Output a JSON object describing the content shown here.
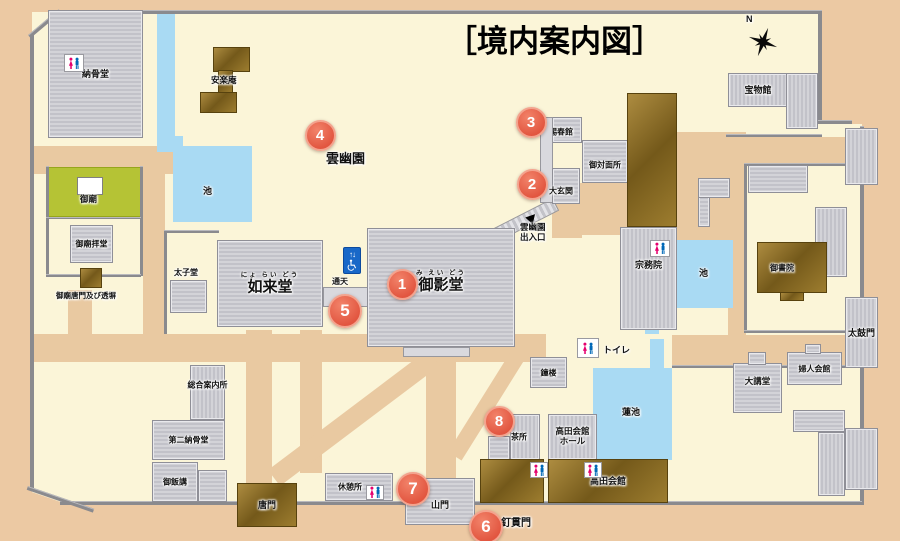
{
  "title": "［境内案内図］",
  "colors": {
    "accent": "#e25640",
    "water": "#a9daf3",
    "grounds": "#fbf5d8",
    "road": "#e9c9a1",
    "mausoleum_green": "#b5c335",
    "roof_gray": "#c9c9ce",
    "roof_brown": "#8a6c23",
    "wall": "#8a8a8e",
    "elevator_blue": "#1968c8",
    "toilet_pink": "#e5006e",
    "toilet_blue": "#0068b7"
  },
  "areas": [
    {
      "name": "grounds-base",
      "cls": "cream",
      "rect": [
        32,
        12,
        830,
        492
      ]
    },
    {
      "name": "outside-sw-corner",
      "cls": "tan",
      "rect": [
        20,
        488,
        88,
        42
      ],
      "rot": 19
    },
    {
      "name": "outside-ne-corner",
      "cls": "tan",
      "rect": [
        820,
        12,
        42,
        112
      ]
    },
    {
      "name": "road-north-of-gobyo",
      "cls": "road",
      "rect": [
        34,
        146,
        140,
        28
      ]
    },
    {
      "name": "road-west-vertical",
      "cls": "road",
      "rect": [
        143,
        148,
        22,
        190
      ]
    },
    {
      "name": "road-karamon-vertical",
      "cls": "road",
      "rect": [
        246,
        330,
        26,
        173
      ]
    },
    {
      "name": "road-main-horizontal",
      "cls": "road",
      "rect": [
        34,
        334,
        512,
        28
      ]
    },
    {
      "name": "road-sanmon-vertical",
      "cls": "road",
      "rect": [
        426,
        356,
        30,
        147
      ]
    },
    {
      "name": "road-center-vertical",
      "cls": "road",
      "rect": [
        300,
        330,
        22,
        143
      ]
    },
    {
      "name": "road-gobyo-gate",
      "cls": "road",
      "rect": [
        68,
        290,
        24,
        48
      ]
    },
    {
      "name": "road-homotsukan",
      "cls": "road",
      "rect": [
        726,
        137,
        120,
        26
      ]
    },
    {
      "name": "road-ne-vertical",
      "cls": "road",
      "rect": [
        728,
        150,
        18,
        185
      ]
    },
    {
      "name": "road-ne-block",
      "cls": "road",
      "rect": [
        677,
        132,
        69,
        108
      ]
    },
    {
      "name": "road-to-taikomon",
      "cls": "road",
      "rect": [
        672,
        335,
        190,
        30
      ]
    },
    {
      "name": "road-genkan-south",
      "cls": "road",
      "rect": [
        552,
        204,
        30,
        34
      ]
    },
    {
      "name": "road-genkan-east",
      "cls": "road",
      "rect": [
        580,
        183,
        48,
        52
      ]
    },
    {
      "name": "road-diagonal-sw",
      "cls": "road",
      "rect": [
        268,
        470,
        200,
        20
      ],
      "rot": -37
    },
    {
      "name": "road-diagonal-ne",
      "cls": "road",
      "rect": [
        448,
        452,
        130,
        16
      ],
      "rot": -58
    },
    {
      "name": "canal",
      "cls": "water",
      "rect": [
        157,
        12,
        18,
        126
      ]
    },
    {
      "name": "canal-bend",
      "cls": "water",
      "rect": [
        157,
        136,
        26,
        16
      ]
    },
    {
      "name": "pond-west",
      "cls": "water",
      "rect": [
        173,
        146,
        79,
        76
      ]
    },
    {
      "name": "pond-east",
      "cls": "water",
      "rect": [
        674,
        240,
        59,
        68
      ]
    },
    {
      "name": "pond-outlet",
      "cls": "water",
      "rect": [
        645,
        318,
        14,
        16
      ]
    },
    {
      "name": "lotus-pond",
      "cls": "water",
      "rect": [
        593,
        368,
        79,
        92
      ]
    },
    {
      "name": "lotus-channel",
      "cls": "water",
      "rect": [
        650,
        339,
        14,
        31
      ]
    },
    {
      "name": "gobyo-mausoleum-green",
      "cls": "green",
      "rect": [
        47,
        167,
        94,
        50
      ]
    },
    {
      "name": "entrance-stairs",
      "cls": "stairs",
      "rect": [
        494,
        228,
        66,
        14
      ],
      "rot": -27
    }
  ],
  "walls": [
    {
      "name": "wall-top",
      "rect": [
        57,
        10,
        763,
        4
      ]
    },
    {
      "name": "wall-ne-vertical",
      "rect": [
        818,
        10,
        4,
        112
      ]
    },
    {
      "name": "wall-ne-horizontal",
      "rect": [
        818,
        120,
        34,
        4
      ]
    },
    {
      "name": "wall-east",
      "rect": [
        860,
        126,
        4,
        379
      ]
    },
    {
      "name": "wall-south",
      "rect": [
        60,
        501,
        802,
        4
      ]
    },
    {
      "name": "wall-west",
      "rect": [
        30,
        34,
        4,
        455
      ]
    },
    {
      "name": "wall-nw-diagonal",
      "rect": [
        28,
        35,
        40,
        4
      ],
      "rot": -40
    },
    {
      "name": "wall-sw-diagonal",
      "rect": [
        28,
        486,
        70,
        4
      ],
      "rot": 19
    },
    {
      "name": "wall-lotus-north",
      "rect": [
        672,
        365,
        190,
        3
      ]
    },
    {
      "name": "fence-homotsukan",
      "rect": [
        726,
        134,
        96,
        3
      ]
    },
    {
      "name": "wall-ne-compound-west",
      "rect": [
        744,
        163,
        3,
        170
      ]
    },
    {
      "name": "wall-ne-compound-north",
      "rect": [
        744,
        163,
        118,
        3
      ]
    },
    {
      "name": "wall-ne-compound-south",
      "rect": [
        744,
        330,
        118,
        3
      ]
    },
    {
      "name": "wall-gobyo-west",
      "rect": [
        46,
        166,
        3,
        110
      ]
    },
    {
      "name": "wall-gobyo-east",
      "rect": [
        140,
        166,
        3,
        110
      ]
    },
    {
      "name": "wall-gobyo-mid",
      "rect": [
        46,
        217,
        95,
        2
      ]
    },
    {
      "name": "wall-gobyo-south",
      "rect": [
        46,
        274,
        95,
        3
      ]
    },
    {
      "name": "wall-taishido-west",
      "rect": [
        164,
        230,
        3,
        104
      ]
    },
    {
      "name": "wall-taishido-north",
      "rect": [
        164,
        230,
        55,
        3
      ]
    }
  ],
  "buildings": [
    {
      "name": "nokotsudo",
      "label": "納骨堂",
      "fs": 9,
      "cls": "b-gray",
      "rect": [
        48,
        10,
        95,
        128
      ]
    },
    {
      "name": "anrakuan-north",
      "cls": "b-brown",
      "rect": [
        213,
        47,
        37,
        25
      ]
    },
    {
      "name": "anrakuan-connector",
      "cls": "b-brown",
      "rect": [
        218,
        70,
        15,
        23
      ]
    },
    {
      "name": "anrakuan-south",
      "cls": "b-brown",
      "rect": [
        200,
        92,
        37,
        21
      ]
    },
    {
      "name": "homotsukan",
      "label": "宝物館",
      "fs": 9,
      "cls": "b-grayv",
      "rect": [
        728,
        73,
        60,
        34
      ]
    },
    {
      "name": "homotsukan-wing",
      "cls": "b-grayv",
      "rect": [
        786,
        73,
        32,
        56
      ]
    },
    {
      "name": "gobyo-worship-hall",
      "label": "御廟拝堂",
      "fs": 8,
      "cls": "b-gray",
      "rect": [
        70,
        225,
        43,
        38
      ]
    },
    {
      "name": "gobyo-karamon-gate",
      "cls": "b-brown",
      "rect": [
        80,
        268,
        22,
        20
      ]
    },
    {
      "name": "taishido",
      "cls": "b-gray",
      "rect": [
        170,
        280,
        37,
        33
      ]
    },
    {
      "name": "nyoraido",
      "label": "如来堂",
      "fs": 15,
      "furigana": "にょ らい どう",
      "cls": "b-gray",
      "rect": [
        217,
        240,
        106,
        87
      ]
    },
    {
      "name": "tsuten-corridor",
      "cls": "b-plain",
      "rect": [
        323,
        287,
        46,
        20
      ]
    },
    {
      "name": "mieido",
      "label": "御影堂",
      "fs": 15,
      "furigana": "み えい どう",
      "cls": "b-gray",
      "rect": [
        367,
        228,
        148,
        119
      ],
      "ldy": -6
    },
    {
      "name": "mieido-porch",
      "cls": "b-plain",
      "rect": [
        403,
        347,
        67,
        10
      ]
    },
    {
      "name": "shishunkan",
      "label": "賜春館",
      "fs": 8,
      "cls": "b-gray",
      "rect": [
        552,
        117,
        30,
        26
      ],
      "ldx": -6,
      "ldy": 2
    },
    {
      "name": "west-corridor",
      "cls": "b-plain",
      "rect": [
        540,
        117,
        13,
        86
      ]
    },
    {
      "name": "gotaimensho",
      "label": "御対面所",
      "fs": 8,
      "cls": "b-gray",
      "rect": [
        582,
        140,
        46,
        43
      ],
      "ldy": 3
    },
    {
      "name": "daigenkan",
      "label": "大玄関",
      "fs": 8,
      "cls": "b-gray",
      "rect": [
        552,
        168,
        28,
        36
      ],
      "ldx": -5,
      "ldy": 5
    },
    {
      "name": "palace-hall",
      "cls": "b-brown",
      "rect": [
        627,
        93,
        50,
        134
      ]
    },
    {
      "name": "shumuin",
      "label": "宗務院",
      "fs": 9,
      "cls": "b-grayv",
      "rect": [
        620,
        227,
        57,
        103
      ],
      "ldy": -14
    },
    {
      "name": "ne-corridor-vertical",
      "cls": "b-gray",
      "rect": [
        698,
        178,
        12,
        49
      ]
    },
    {
      "name": "ne-corridor-horizontal",
      "cls": "b-gray",
      "rect": [
        698,
        178,
        32,
        20
      ]
    },
    {
      "name": "ne-hall-north",
      "cls": "b-gray",
      "rect": [
        748,
        165,
        60,
        28
      ]
    },
    {
      "name": "ne-hall-east",
      "cls": "b-grayv",
      "rect": [
        815,
        207,
        32,
        70
      ]
    },
    {
      "name": "ne-hall-east-wing",
      "cls": "b-gray",
      "rect": [
        790,
        243,
        27,
        32
      ]
    },
    {
      "name": "goshoin",
      "label": "御書院",
      "fs": 8,
      "cls": "b-brown",
      "rect": [
        757,
        242,
        70,
        51
      ],
      "ldx": -10
    },
    {
      "name": "goshoin-annex",
      "cls": "b-brown",
      "rect": [
        780,
        292,
        24,
        9
      ]
    },
    {
      "name": "shoro-bell-tower",
      "label": "鐘楼",
      "fs": 8,
      "cls": "b-gray",
      "rect": [
        530,
        357,
        37,
        31
      ]
    },
    {
      "name": "chadokoro",
      "label": "茶所",
      "fs": 8,
      "cls": "b-grayv",
      "rect": [
        510,
        414,
        30,
        46
      ],
      "ldx": -6
    },
    {
      "name": "chadokoro-annex",
      "cls": "b-gray",
      "rect": [
        488,
        436,
        22,
        24
      ]
    },
    {
      "name": "takada-kaikan-hall",
      "label": "高田会館\nホール",
      "fs": 8.5,
      "cls": "b-grayv",
      "rect": [
        548,
        414,
        49,
        46
      ]
    },
    {
      "name": "takada-kaikan-west",
      "cls": "b-brown",
      "rect": [
        480,
        459,
        64,
        44
      ]
    },
    {
      "name": "takada-kaikan",
      "label": "高田会館",
      "fs": 9,
      "cls": "b-brown",
      "rect": [
        548,
        459,
        120,
        44
      ]
    },
    {
      "name": "daikodo",
      "label": "大講堂",
      "fs": 8.5,
      "cls": "b-gray",
      "rect": [
        733,
        363,
        49,
        50
      ],
      "ldy": -6
    },
    {
      "name": "daikodo-entry",
      "cls": "b-gray",
      "rect": [
        748,
        352,
        18,
        13
      ]
    },
    {
      "name": "fujin-kaikan",
      "label": "婦人会館",
      "fs": 8,
      "cls": "b-gray",
      "rect": [
        787,
        352,
        55,
        33
      ]
    },
    {
      "name": "fujin-kaikan-entry",
      "cls": "b-gray",
      "rect": [
        805,
        344,
        16,
        10
      ]
    },
    {
      "name": "se-annex-top",
      "cls": "b-gray",
      "rect": [
        793,
        410,
        52,
        22
      ]
    },
    {
      "name": "se-annex-right",
      "cls": "b-grayv",
      "rect": [
        818,
        432,
        27,
        64
      ]
    },
    {
      "name": "taikomon-gate",
      "label": "太鼓門",
      "fs": 9,
      "cls": "b-grayv",
      "rect": [
        845,
        297,
        33,
        71
      ]
    },
    {
      "name": "ne-gate",
      "cls": "b-grayv",
      "rect": [
        845,
        128,
        33,
        57
      ]
    },
    {
      "name": "se-gate",
      "cls": "b-grayv",
      "rect": [
        845,
        428,
        33,
        62
      ]
    },
    {
      "name": "karamon-gate",
      "label": "唐門",
      "fs": 9,
      "cls": "b-brown",
      "rect": [
        237,
        483,
        60,
        44
      ]
    },
    {
      "name": "sanmon-gate",
      "label": "山門",
      "fs": 9,
      "cls": "b-gray",
      "rect": [
        405,
        478,
        70,
        47
      ],
      "ldy": 3
    },
    {
      "name": "kyukeisho-rest-area",
      "label": "休憩所",
      "fs": 8,
      "cls": "b-gray",
      "rect": [
        325,
        473,
        68,
        28
      ],
      "ldx": -9
    },
    {
      "name": "sogo-information",
      "label": "総合案内所",
      "fs": 8,
      "cls": "b-grayv",
      "rect": [
        190,
        365,
        35,
        55
      ],
      "ldy": -8
    },
    {
      "name": "daini-nokotsudo",
      "label": "第二納骨堂",
      "fs": 8,
      "cls": "b-gray",
      "rect": [
        152,
        420,
        73,
        40
      ]
    },
    {
      "name": "gohanko",
      "label": "御飯講",
      "fs": 8,
      "cls": "b-gray",
      "rect": [
        152,
        462,
        46,
        40
      ]
    },
    {
      "name": "small-hall",
      "cls": "b-gray",
      "rect": [
        198,
        470,
        29,
        32
      ]
    },
    {
      "name": "gobyo-shrine",
      "cls": "b-white",
      "rect": [
        77,
        177,
        26,
        18
      ]
    }
  ],
  "labels": [
    {
      "name": "label-gobyo",
      "text": "御廟",
      "x": 80,
      "y": 194,
      "fs": 8.5
    },
    {
      "name": "label-gobyo-karamon",
      "text": "御廟唐門及び透塀",
      "x": 56,
      "y": 291,
      "fs": 7.5
    },
    {
      "name": "label-taishido",
      "text": "太子堂",
      "x": 174,
      "y": 268,
      "fs": 8
    },
    {
      "name": "label-anrakuan",
      "text": "安楽庵",
      "x": 211,
      "y": 75,
      "fs": 8.5
    },
    {
      "name": "label-pond-west",
      "text": "池",
      "x": 203,
      "y": 186,
      "fs": 9
    },
    {
      "name": "label-unyuen-garden",
      "text": "雲幽園",
      "x": 326,
      "y": 151,
      "fs": 13
    },
    {
      "name": "label-tsuten",
      "text": "通天",
      "x": 332,
      "y": 277,
      "fs": 8
    },
    {
      "name": "label-unyuen-exit",
      "text": "雲幽園\n出入口",
      "x": 520,
      "y": 222,
      "fs": 8.5
    },
    {
      "name": "label-pond-east",
      "text": "池",
      "x": 699,
      "y": 268,
      "fs": 9
    },
    {
      "name": "label-toilet",
      "text": "トイレ",
      "x": 603,
      "y": 345,
      "fs": 9
    },
    {
      "name": "label-hasuike",
      "text": "蓮池",
      "x": 622,
      "y": 407,
      "fs": 9
    },
    {
      "name": "label-kuginukimon",
      "text": "釘貫門",
      "x": 501,
      "y": 518,
      "fs": 10
    },
    {
      "name": "label-compass-n",
      "text": "N",
      "x": 746,
      "y": 14,
      "fs": 9
    }
  ],
  "markers": [
    {
      "num": "1",
      "cx": 400,
      "cy": 282
    },
    {
      "num": "2",
      "cx": 530,
      "cy": 182
    },
    {
      "num": "3",
      "cx": 529,
      "cy": 120
    },
    {
      "num": "4",
      "cx": 318,
      "cy": 133
    },
    {
      "num": "5",
      "cx": 343,
      "cy": 309,
      "size": 30
    },
    {
      "num": "6",
      "cx": 484,
      "cy": 525,
      "size": 30
    },
    {
      "num": "7",
      "cx": 411,
      "cy": 487,
      "size": 30
    },
    {
      "num": "8",
      "cx": 497,
      "cy": 419
    }
  ],
  "icons": [
    {
      "type": "toilet",
      "name": "toilet-icon-nokotsudo",
      "rect": [
        64,
        54,
        20,
        18
      ]
    },
    {
      "type": "toilet",
      "name": "toilet-icon-shumuin",
      "rect": [
        650,
        240,
        20,
        17
      ]
    },
    {
      "type": "toilet",
      "name": "toilet-icon-standalone",
      "rect": [
        577,
        338,
        22,
        20
      ]
    },
    {
      "type": "toilet",
      "name": "toilet-icon-kyukeisho",
      "rect": [
        366,
        485,
        18,
        15
      ]
    },
    {
      "type": "toilet",
      "name": "toilet-icon-takada-west",
      "rect": [
        530,
        462,
        18,
        16
      ]
    },
    {
      "type": "toilet",
      "name": "toilet-icon-takada",
      "rect": [
        584,
        462,
        18,
        16
      ]
    },
    {
      "type": "elevator",
      "name": "elevator-icon",
      "rect": [
        343,
        247,
        18,
        27
      ]
    },
    {
      "type": "arrow",
      "name": "entrance-arrow-icon",
      "rect": [
        527,
        213,
        10,
        10
      ]
    },
    {
      "type": "compass",
      "name": "compass-icon",
      "rect": [
        744,
        22,
        38,
        40
      ]
    }
  ]
}
